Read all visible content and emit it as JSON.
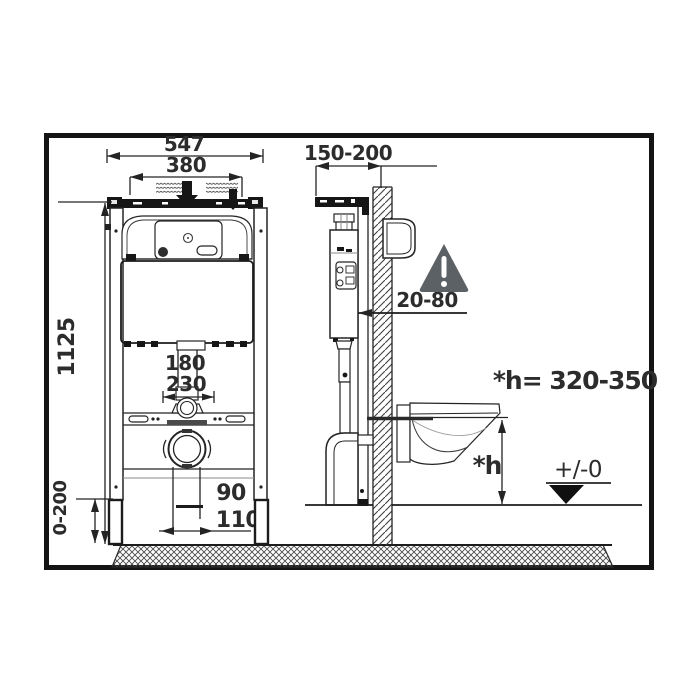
{
  "diagram": {
    "type": "wc-concealed-frame-installation-drawing",
    "colors": {
      "line": "#242424",
      "warning_triangle": "#5c6165",
      "background": "#ffffff"
    },
    "front_view": {
      "overall_width": "547",
      "mounting_width": "380",
      "frame_height": "1125",
      "leg_adjustment": "0-200",
      "flush_bend_offset": "180",
      "water_supply_offset": "230",
      "outlet_offset": "90",
      "outlet_diameter": "110"
    },
    "side_view": {
      "frame_depth": "150-200",
      "wall_clearance": "20-80",
      "seat_height_formula": "*h= 320-350",
      "seat_height_symbol": "*h",
      "floor_level": "+/-0"
    },
    "icons": {
      "warning": "exclamation-triangle-icon"
    }
  }
}
